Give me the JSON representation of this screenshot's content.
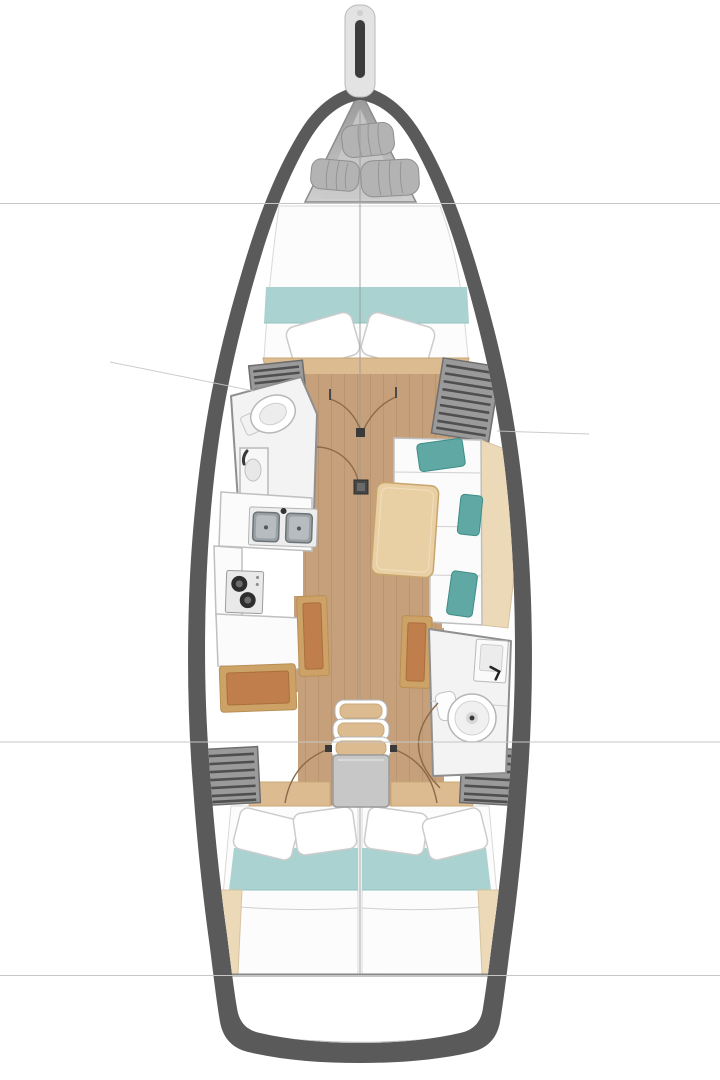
{
  "meta": {
    "type": "sailboat-interior-floor-plan",
    "orientation": "bow-up",
    "areas": [
      "bowsprit",
      "sail-locker",
      "forward-berth",
      "forward-head",
      "galley",
      "saloon",
      "aft-head",
      "companionway",
      "aft-berth-port",
      "aft-berth-starboard",
      "stern"
    ]
  },
  "colors": {
    "hull": "#5a5a5a",
    "deck": "#ffffff",
    "room": "#f3f3f3",
    "teal": "#a9d2d0",
    "tealdark": "#5fa8a3",
    "floor": "#c6a07b",
    "wood": "#dcbb90",
    "woodlight": "#ecd9b8",
    "table": "#e9cfa4",
    "benchwood": "#cda266",
    "cushion": "#c07e4c",
    "locker": "#9a9a9a",
    "slat": "#4f4f4f",
    "bedwhite": "#fcfcfc",
    "roll": "#b3b3b3",
    "arc": "#8a6a49",
    "line": "#c6c6c6",
    "platform": "#c7c7c7",
    "fixture": "#f7f7f7",
    "steel": "#9aa1a5"
  }
}
